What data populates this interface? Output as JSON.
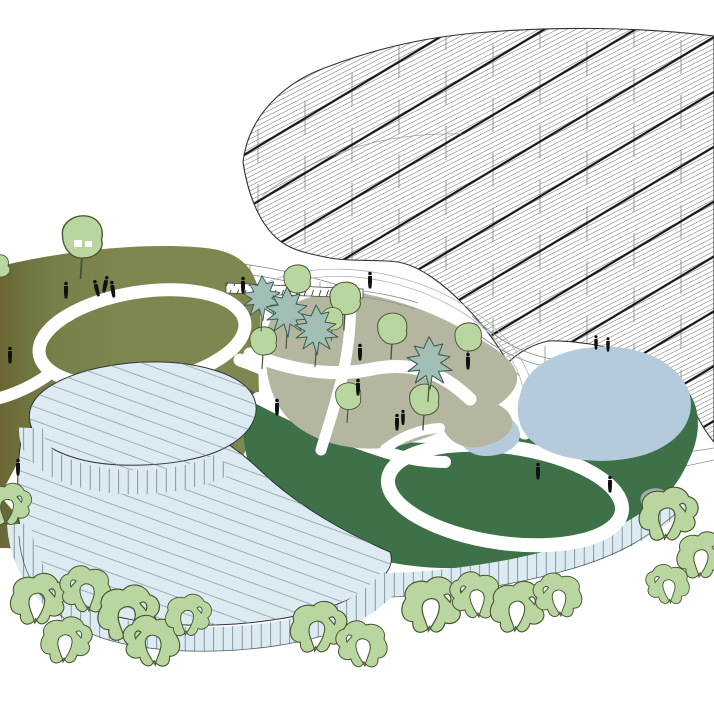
{
  "scene": {
    "type": "architectural axonometric illustration",
    "title": "Circular pavilion complex with free-form gridshell canopy, landscaped roof hills, courtyard garden and ponds",
    "regions": [
      {
        "name": "gridshell-canopy",
        "desc": "large free-form canopy roof with fine diagonal hatching, bold diagonal ribs and slender vertical columns",
        "position": "top right"
      },
      {
        "name": "olive-hill-roof",
        "desc": "olive-green landscaped roof hill with white looping walking path and figures, darker toward the left edge",
        "position": "left"
      },
      {
        "name": "courtyard-garden",
        "desc": "sunken courtyard garden with beige gravel patches, round deciduous trees, jagged evergreen trees and white paths, ringed by a colonnade walkway with a hatched crosswalk strip",
        "position": "center"
      },
      {
        "name": "green-roof-lawn",
        "desc": "dark green lawn roof with a white loop path, raised over a glazed facade of vertical mullions",
        "position": "bottom right"
      },
      {
        "name": "large-pond",
        "desc": "free-form reflecting pond tucked under the scalloped canopy edge",
        "position": "right"
      },
      {
        "name": "small-pond",
        "desc": "small pond beside the walkway between garden and lawn",
        "position": "center right"
      },
      {
        "name": "round-pavilion",
        "desc": "two stacked cylindrical pavilions with diagonally striped roofs and vertical-mullion drum walls",
        "position": "bottom left"
      },
      {
        "name": "perimeter-trees",
        "desc": "stylized light-green blob trees with white cut-outs lining the base of the buildings",
        "position": "bottom and right edges"
      }
    ],
    "counts": {
      "person_figures": 18,
      "garden_round_trees": 8,
      "garden_conifers": 4,
      "perimeter_trees": 17,
      "canopy_ribs": "~12 visible",
      "ponds": 2
    }
  },
  "colors": {
    "paper": "#ffffff",
    "hatch": "#3c3c3c",
    "rib": "#161616",
    "outline": "#333333",
    "colLine": "#8a8f94",
    "thinLine": "#8a9096",
    "hillLight": "#7e8750",
    "hillMid": "#778049",
    "hillDark": "#6a6735",
    "greenRoof": "#3e7148",
    "beige": "#b5b6a0",
    "pond": "#b4cadd",
    "building": "#dcebf2",
    "stripe": "#8d979e",
    "structure": "#2f3337",
    "wallLine": "#72808a",
    "treeLight": "#b9d5a0",
    "treeOutline": "#46552f",
    "conifer": "#a2bfb6",
    "coniferOutline": "#3d5a4f",
    "figure": "#111111",
    "path": "#ffffff",
    "rock": "#a8adaa"
  }
}
